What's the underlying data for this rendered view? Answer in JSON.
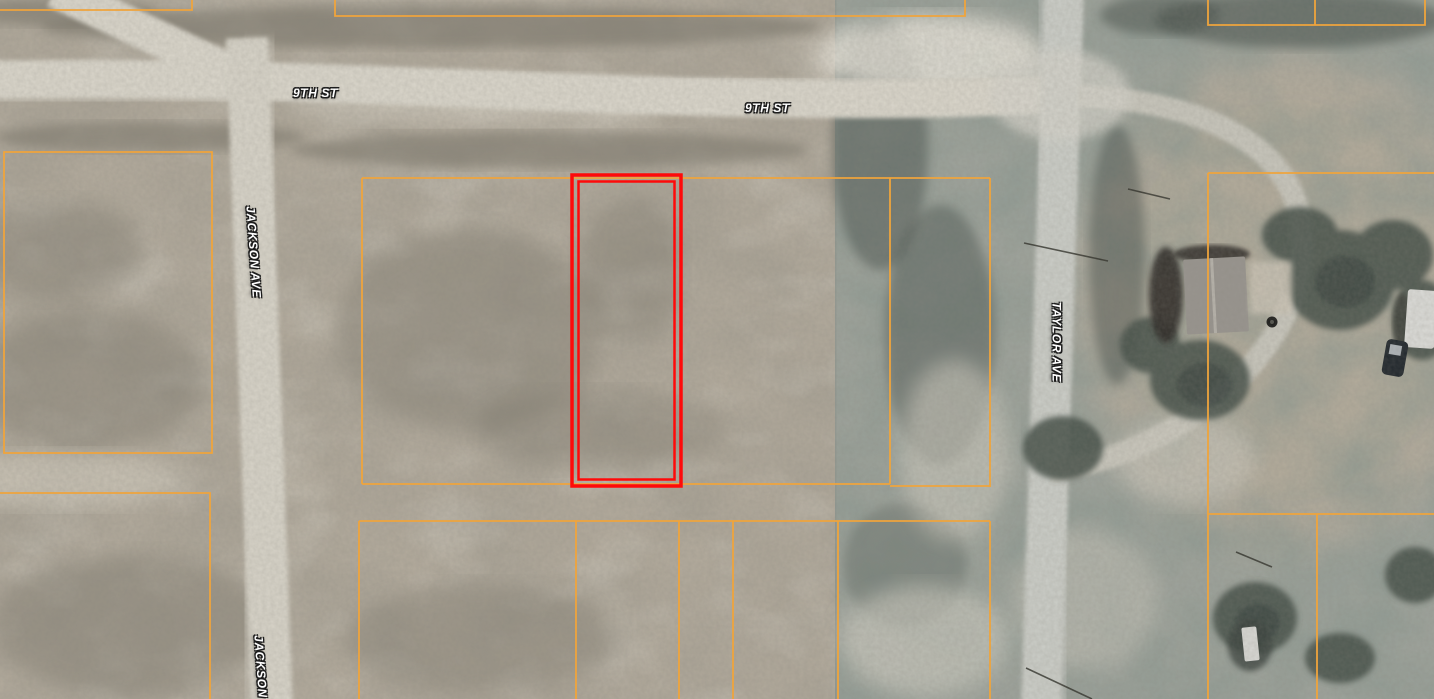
{
  "map": {
    "view": "aerial-parcel-map",
    "labels": {
      "ninth_st_west": "9TH ST",
      "ninth_st_east": "9TH ST",
      "jackson_ave_north": "JACKSON AVE",
      "jackson_ave_south": "JACKSON AVE",
      "taylor_ave": "TAYLOR AVE"
    },
    "colors": {
      "parcel_line": "#efa43c",
      "highlight_outline": "#fe0a0a",
      "label_fill": "#ffffff",
      "label_outline": "#1c1c1c"
    }
  }
}
